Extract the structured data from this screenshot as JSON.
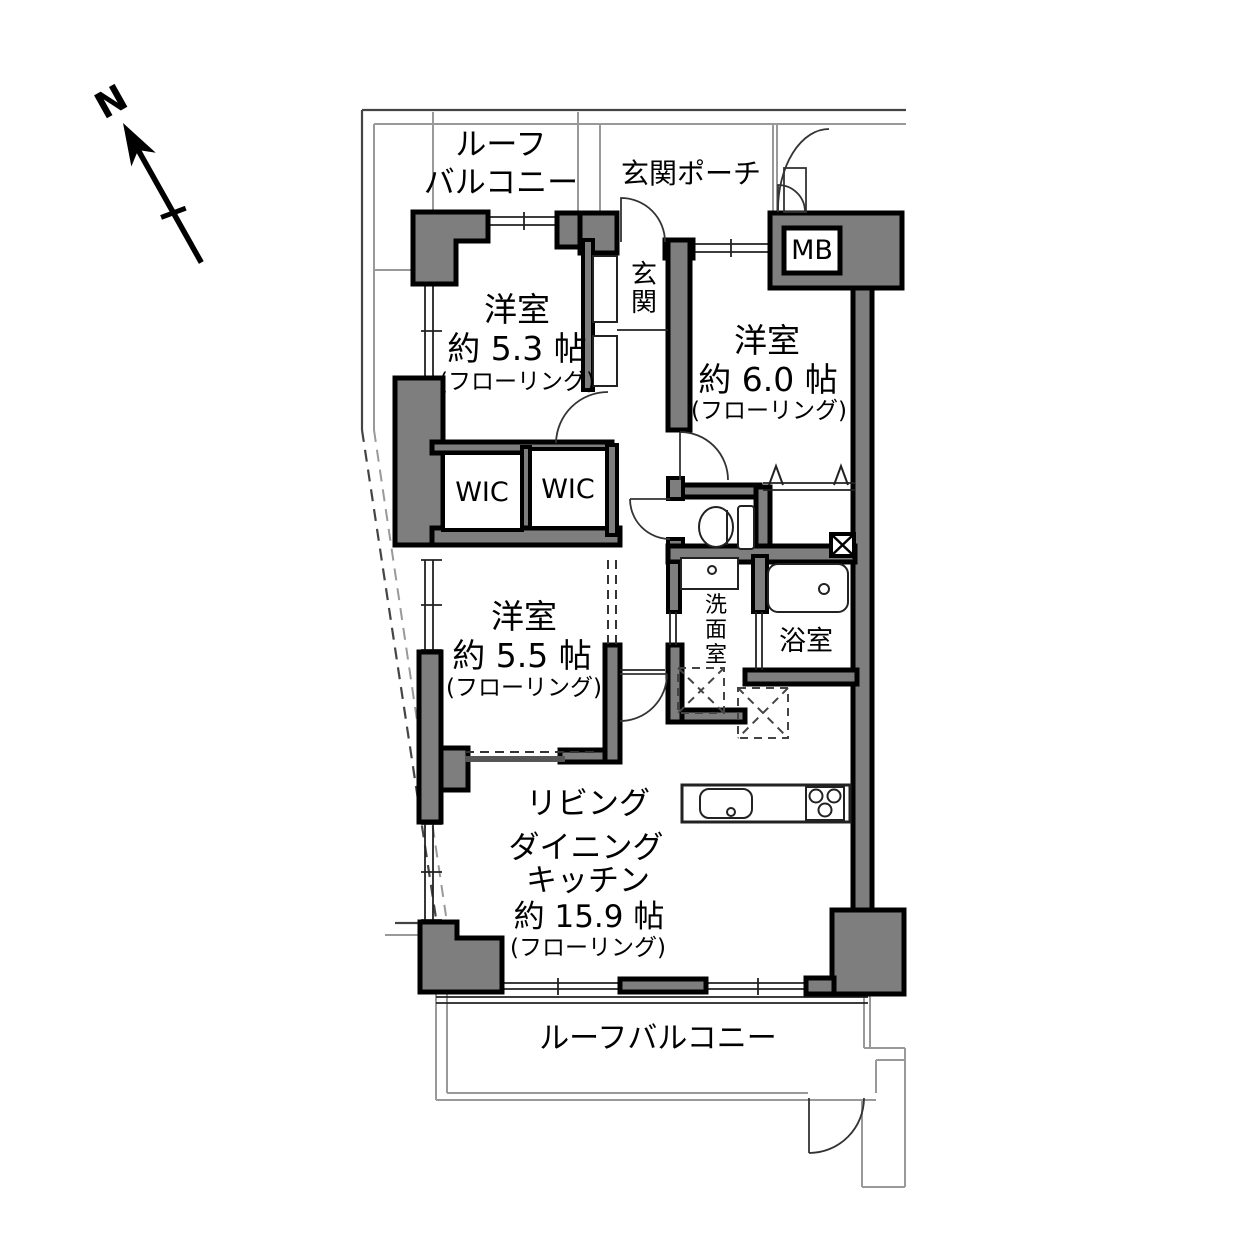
{
  "compass": {
    "north": "N"
  },
  "outdoor": {
    "roof_balcony_top_line1": "ルーフ",
    "roof_balcony_top_line2": "バルコニー",
    "entrance_porch": "玄関ポーチ",
    "roof_balcony_bottom": "ルーフバルコニー"
  },
  "utility": {
    "meter_box": "MB"
  },
  "rooms": {
    "bedroom53": {
      "name": "洋室",
      "size": "約 5.3 帖",
      "floor": "(フローリング)"
    },
    "bedroom60": {
      "name": "洋室",
      "size": "約 6.0 帖",
      "floor": "(フローリング)"
    },
    "bedroom55": {
      "name": "洋室",
      "size": "約 5.5 帖",
      "floor": "(フローリング)"
    },
    "ldk": {
      "line1": "リビング",
      "line2": "ダイニング",
      "line3": "キッチン",
      "size": "約 15.9 帖",
      "floor": "(フローリング)"
    },
    "entrance": {
      "name": "玄関"
    },
    "washroom": {
      "name": "洗面室"
    },
    "bathroom": {
      "name": "浴室"
    },
    "wic_left": {
      "name": "WIC"
    },
    "wic_right": {
      "name": "WIC"
    }
  },
  "colors": {
    "wall_fill": "#7e7e7e",
    "wall_line": "#000000",
    "boundary_line": "#999999",
    "background": "#ffffff"
  }
}
